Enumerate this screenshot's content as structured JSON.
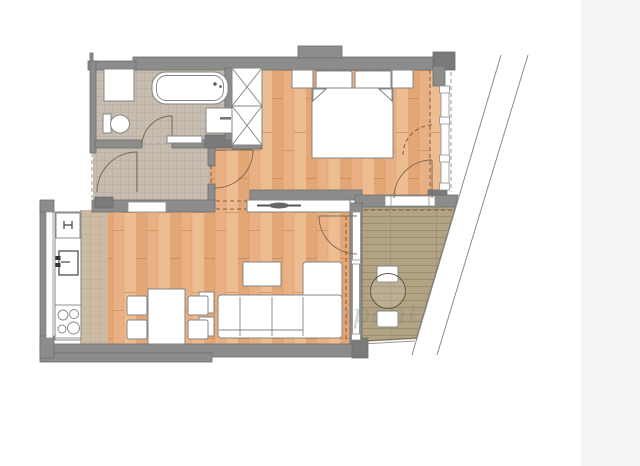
{
  "watermark": {
    "text": "ingatlanpont"
  },
  "colors": {
    "background": "#ffffff",
    "right_panel": "#f4f4f4",
    "wall": "#8c8c8c",
    "wall_dark": "#7a7a7a",
    "wall_stroke": "#6d6d6d",
    "floor_wood": "#e9b183",
    "wood_stripe_dark": "#dfa06e",
    "wood_stripe_light": "#efbe93",
    "tile_bath": "#c6bcb0",
    "tile_bath_line": "#b0a497",
    "tile_kitchen": "#cdbaa4",
    "tile_kitchen_line": "#b8a48b",
    "deck": "#b2a384",
    "deck_line": "#998a66",
    "furniture_fill": "#ffffff",
    "outline": "#858585",
    "door_arc": "#7d6a52",
    "dash_brown": "#7d4a35",
    "dash_gray": "#9a9a9a",
    "boundary_line": "#8a8a8a",
    "watermark_color": "#8e8e82"
  },
  "rooms": [
    {
      "name": "bathroom"
    },
    {
      "name": "hallway"
    },
    {
      "name": "bedroom"
    },
    {
      "name": "living-room-kitchen"
    },
    {
      "name": "balcony"
    }
  ]
}
